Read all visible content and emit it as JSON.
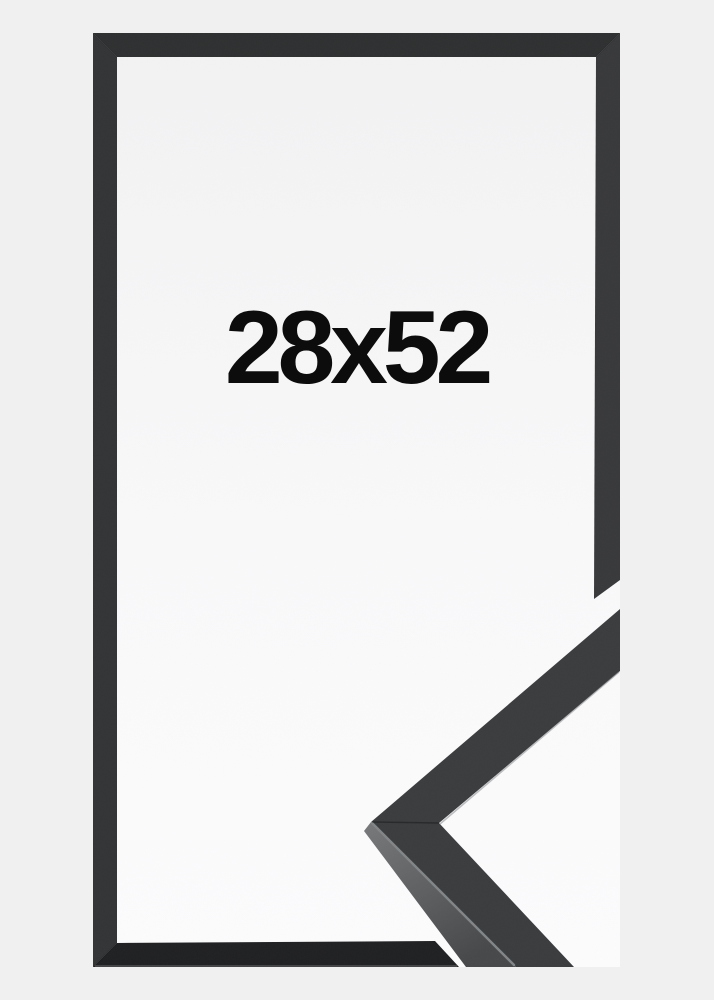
{
  "product": {
    "size_label": "28x52",
    "frame_style": "black picture frame, corner moulding sample overlapping bottom-right",
    "colors": {
      "page_background": "#f0f0f1",
      "inner_top": "#f2f2f3",
      "inner_mid": "#f9f9fa",
      "inner_bottom": "#fcfcfd",
      "frame_top": "#2f3031",
      "frame_left": "#333436",
      "frame_right": "#38393b",
      "frame_bottom": "#202123",
      "sample_face": "#3a3c3e",
      "sample_side_light": "#77797b",
      "sample_side_dark": "#46484a",
      "sample_edge_highlight": "#828587",
      "label_text": "#0c0c0c"
    }
  }
}
